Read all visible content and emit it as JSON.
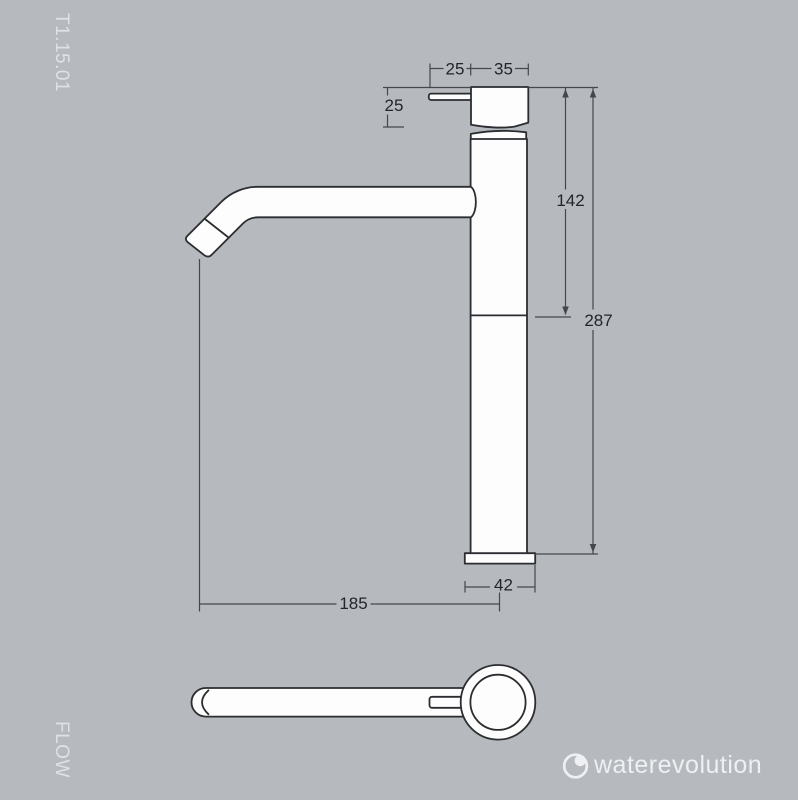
{
  "page": {
    "product_code": "T1.15.01",
    "side_label": "FLOW"
  },
  "brand": {
    "name": "waterevolution"
  },
  "drawing": {
    "description": "Technical drawing of tall single-lever basin mixer tap, side view and top view, dimensions in mm",
    "dims": {
      "lever_length": "25",
      "head_width": "35",
      "head_height": "25",
      "upper_body_height": "142",
      "total_height": "287",
      "base_width": "42",
      "spout_reach": "185"
    }
  },
  "colors": {
    "background": "#b6b9bd",
    "outline": "#2b2d30",
    "dimension_line": "#45474b",
    "dimension_text": "#232529",
    "fill_white": "#fdfdfe",
    "margin_text": "#dfe2e5",
    "logo_text": "#eef0f3"
  }
}
